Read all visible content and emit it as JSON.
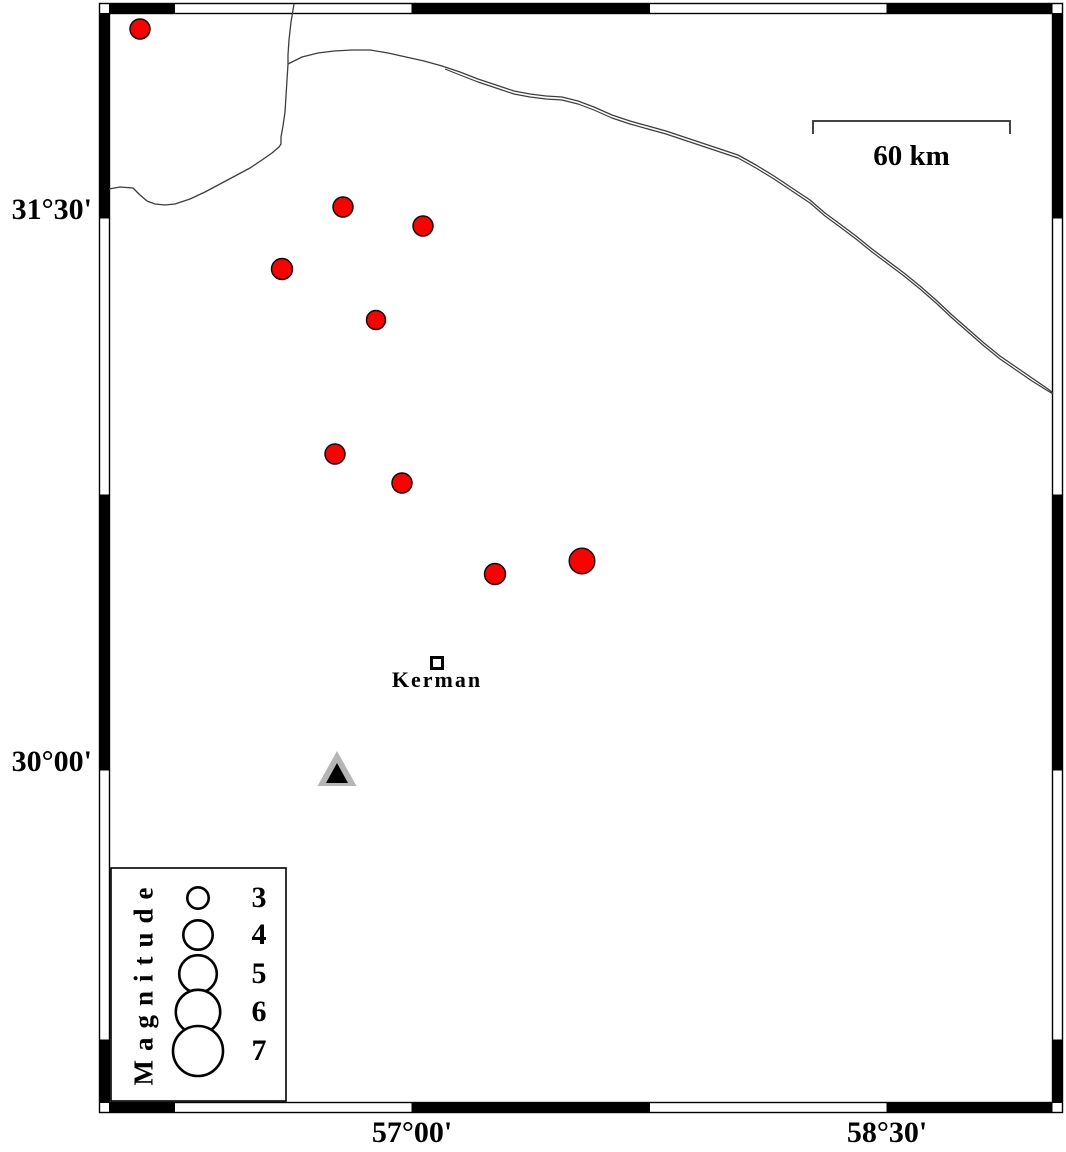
{
  "figure_type": "earthquake epicenter map (GMT-style seismicity map)",
  "axes": {
    "left": [
      {
        "label": "31°30'",
        "y_px": 218
      },
      {
        "label": "30°00'",
        "y_px": 770
      }
    ],
    "bottom": [
      {
        "label": "57°00'",
        "x_px": 412
      },
      {
        "label": "58°30'",
        "x_px": 887
      }
    ]
  },
  "frame": {
    "inner": {
      "x1": 109,
      "y1": 13,
      "x2": 1052.5,
      "y2": 1103
    },
    "band_px": 10,
    "x_tick_boundaries": [
      174.5,
      412,
      649.5,
      887
    ],
    "y_tick_boundaries": [
      218,
      495,
      770,
      1040
    ]
  },
  "scale_bar": {
    "label": "60 km",
    "x1_px": 813,
    "x2_px": 1010,
    "y_px": 121,
    "tick_drop_px": 13
  },
  "city": {
    "name": "Kerman",
    "x_px": 437,
    "y_px": 663
  },
  "seismic_station": {
    "shape": "triangle",
    "x_px": 337,
    "y_px": 770
  },
  "earthquakes": {
    "marker_fill": "#fc0000",
    "events": [
      {
        "x_px": 140,
        "y_px": 29,
        "r_px": 10,
        "lon_approx": 56.14,
        "lat_approx": 32.01,
        "mag_approx": 3.0
      },
      {
        "x_px": 343,
        "y_px": 207,
        "r_px": 10,
        "lon_approx": 56.78,
        "lat_approx": 31.53,
        "mag_approx": 3.0
      },
      {
        "x_px": 423,
        "y_px": 226,
        "r_px": 10,
        "lon_approx": 57.03,
        "lat_approx": 31.48,
        "mag_approx": 3.0
      },
      {
        "x_px": 282,
        "y_px": 269,
        "r_px": 10.5,
        "lon_approx": 56.59,
        "lat_approx": 31.36,
        "mag_approx": 3.1
      },
      {
        "x_px": 376,
        "y_px": 320,
        "r_px": 9.5,
        "lon_approx": 56.89,
        "lat_approx": 31.22,
        "mag_approx": 2.9
      },
      {
        "x_px": 335,
        "y_px": 454,
        "r_px": 10,
        "lon_approx": 56.76,
        "lat_approx": 30.86,
        "mag_approx": 3.0
      },
      {
        "x_px": 402,
        "y_px": 483,
        "r_px": 10,
        "lon_approx": 56.97,
        "lat_approx": 30.78,
        "mag_approx": 3.0
      },
      {
        "x_px": 495,
        "y_px": 574,
        "r_px": 10.5,
        "lon_approx": 57.26,
        "lat_approx": 30.53,
        "mag_approx": 3.1
      },
      {
        "x_px": 582,
        "y_px": 561,
        "r_px": 12.8,
        "lon_approx": 57.54,
        "lat_approx": 30.57,
        "mag_approx": 3.5
      }
    ]
  },
  "legend": {
    "title": "Magnitude",
    "box": {
      "x": 111,
      "y": 868,
      "w": 175,
      "h": 233
    },
    "circle_cx_px": 198,
    "label_cx_px": 259,
    "title_cx_px": 144,
    "entries": [
      {
        "label": "3",
        "cy_px": 898,
        "r_px": 10.7
      },
      {
        "label": "4",
        "cy_px": 935,
        "r_px": 14.7
      },
      {
        "label": "5",
        "cy_px": 974,
        "r_px": 18.8
      },
      {
        "label": "6",
        "cy_px": 1012,
        "r_px": 22.2
      },
      {
        "label": "7",
        "cy_px": 1051,
        "r_px": 25
      }
    ]
  },
  "colors": {
    "event_red": "#fc0000",
    "frame_black": "#000000",
    "boundary_line": "#3d3d3d",
    "station_gray": "#b5b5b5",
    "background": "#ffffff"
  }
}
